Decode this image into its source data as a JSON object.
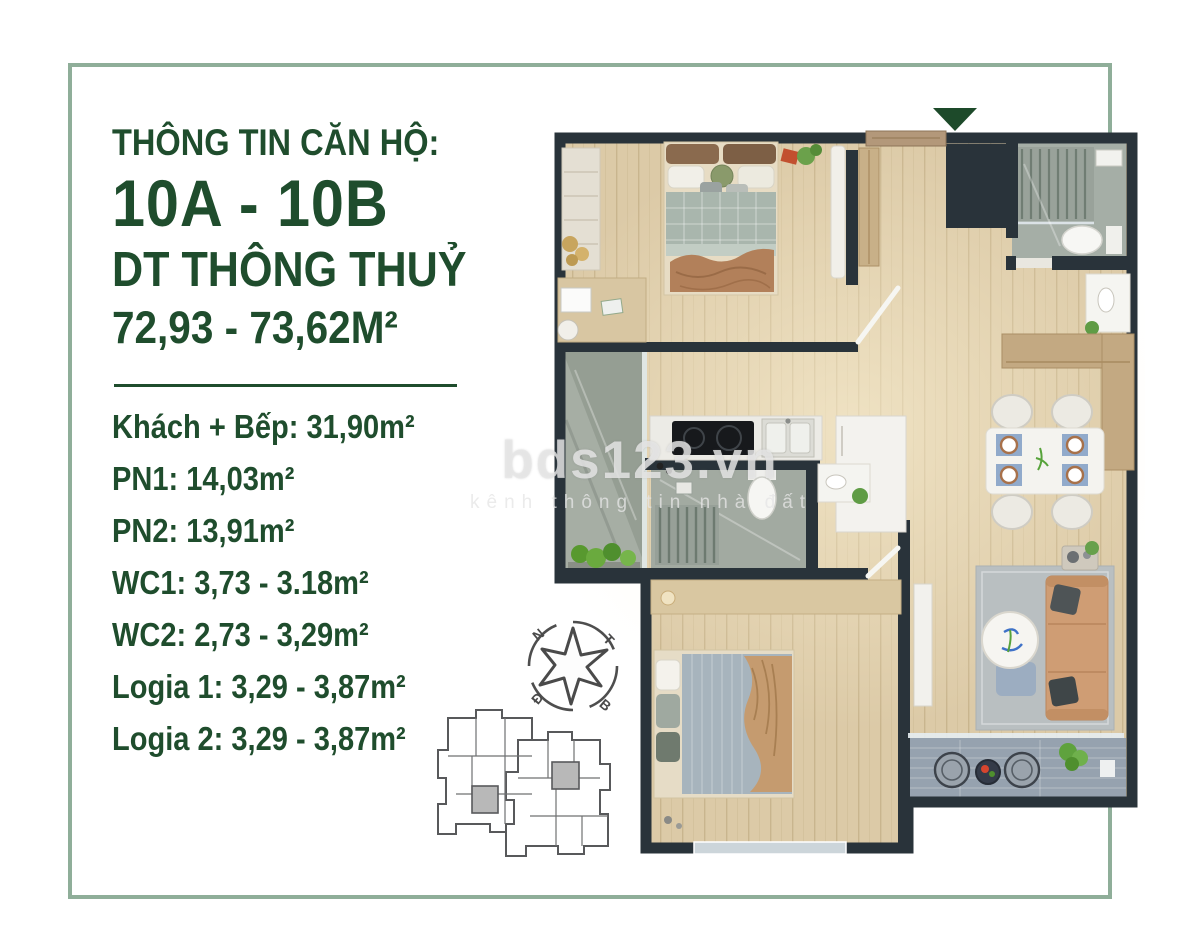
{
  "info_panel": {
    "title": "THÔNG TIN CĂN HỘ:",
    "unit_code": "10A - 10B",
    "area_label": "DT THÔNG THUỶ",
    "area_value": "72,93 - 73,62M²",
    "rooms": [
      "Khách + Bếp: 31,90m²",
      "PN1: 14,03m²",
      "PN2: 13,91m²",
      "WC1: 3,73 - 3.18m²",
      "WC2: 2,73 - 3,29m²",
      "Logia 1: 3,29 - 3,87m²",
      "Logia 2: 3,29 - 3,87m²"
    ]
  },
  "watermark": {
    "brand": "bds123.vn",
    "tagline": "kênh thông tin nhà đất"
  },
  "compass": {
    "top_left": "N",
    "top_right": "T",
    "bottom_left": "Đ",
    "bottom_right": "B"
  },
  "colors": {
    "accent_green": "#1f4d2d",
    "frame_green": "#8fae99",
    "entrance_arrow": "#1d4a2a",
    "wall": "#29333a"
  }
}
